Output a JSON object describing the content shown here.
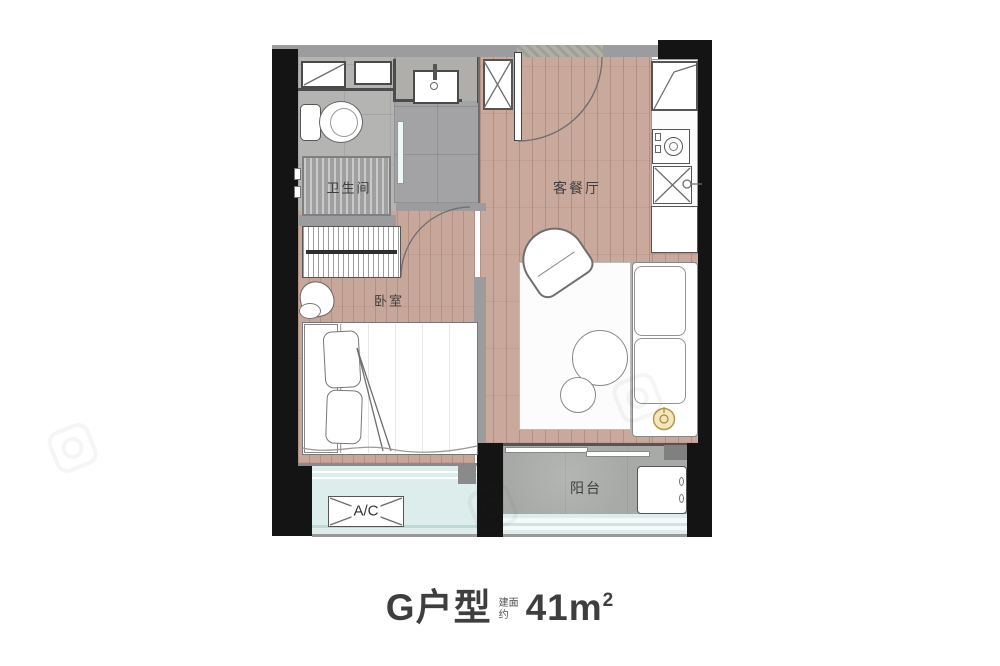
{
  "title": {
    "unit_name": "G户型",
    "area_label_line1": "建面",
    "area_label_line2": "约",
    "area_value": "41m",
    "area_exponent": "2"
  },
  "rooms": {
    "bathroom": "卫生间",
    "bedroom": "卧室",
    "living_dining": "客餐厅",
    "balcony": "阳台",
    "ac_unit": "A/C"
  },
  "colors": {
    "wall_black": "#141414",
    "wall_gray": "#9c9c9e",
    "wood_floor": "#c9a99c",
    "tile_light": "#b4b4b2",
    "tile_dark": "#a3a3a5",
    "balcony_floor": "#a8aaa7",
    "glass_cyan": "#dcedec",
    "accent_gold": "#b5974d",
    "title_text": "#3e3e3e"
  }
}
